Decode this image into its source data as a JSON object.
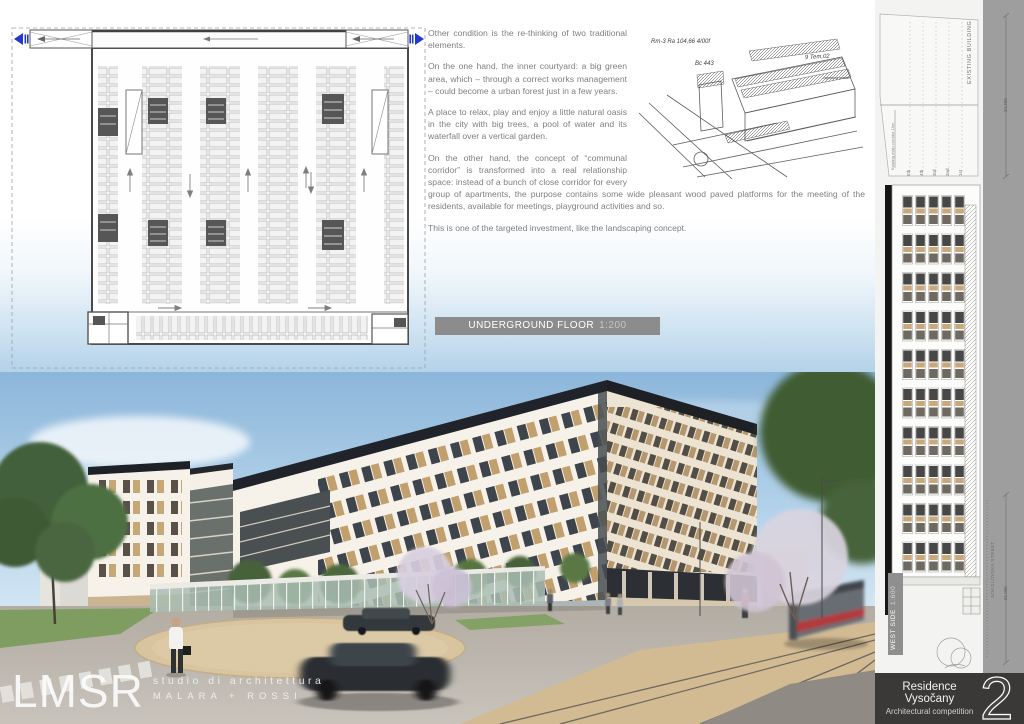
{
  "poster": {
    "essay": {
      "p1": "Other condition is the re-thinking of two traditional elements.",
      "p2": "On the one hand, the inner courtyard: a big green area, which – through a correct works management – could become a urban forest just in a few years.",
      "p3": "A place to relax, play and enjoy a little natural oasis in the city with big trees, a pool of water and its waterfall over a vertical garden.",
      "p4": "On the other hand, the concept of “communal corridor” is transformed into a real relationship space: instead of a bunch of close corridor for every group of apartments, the purpose contains some wide pleasant wood paved platforms for the meeting of the residents, available for meetings, playground activities and so.",
      "p5": "This is one of the targeted investment, like the landscaping concept."
    },
    "plan_label": {
      "title": "UNDERGROUND FLOOR",
      "scale": "1:200"
    },
    "sketch": {
      "annotations": [
        "Rm-3  Ra 104,66  4/00f",
        "Bc 443",
        "9 Tem,02",
        "copertura prefab"
      ]
    }
  },
  "sidebar": {
    "existing_building_label": "EXISTING BUILDING",
    "corridor_note": "Existing main corridor 19m",
    "floor_labels": [
      "5th",
      "4th",
      "3rd",
      "2nd",
      "1st"
    ],
    "west_side_label": {
      "title": "WEST SIDE",
      "scale": "1:600"
    },
    "street_label": "SOKOLOVSKA STREET",
    "dimension_top": "34.400",
    "dimension_bottom": "81.000"
  },
  "footer": {
    "logo": {
      "initials": "LMSR",
      "tagline": "studio di architettura",
      "names": "MALARA + ROSSI"
    },
    "title_block": {
      "project": "Residence Vysočany",
      "subtitle": "Architectural competition",
      "page_number": "2"
    }
  },
  "colors": {
    "accent_blue_icon": "#2438cc",
    "label_bar": "#8c8c8c",
    "title_bar": "#3b3938",
    "facade_tan": "#c2a06e",
    "sky_top": "#8cb6da"
  }
}
